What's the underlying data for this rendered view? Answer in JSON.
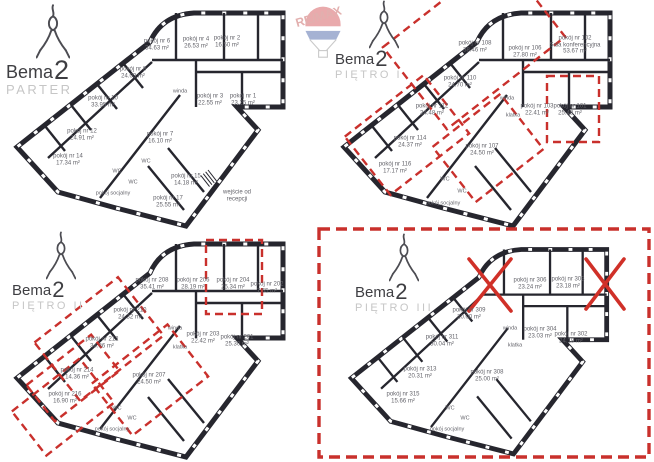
{
  "brand": {
    "name": "Bema",
    "number": "2",
    "watermark": "RE/MAX"
  },
  "colors": {
    "wall": "#26262e",
    "highlight_red": "#c9302c",
    "label_gray": "#63636a"
  },
  "floors": [
    {
      "name": "PARTER",
      "rooms": [
        {
          "label": "pokój nr 6",
          "area": "34.63 m²"
        },
        {
          "label": "pokój nr 4",
          "area": "26.53 m²"
        },
        {
          "label": "pokój nr 2",
          "area": "16.50 m²"
        },
        {
          "label": "pokój nr 8",
          "area": "24.03 m²"
        },
        {
          "label": "pokój nr 10",
          "area": "33.95 m²"
        },
        {
          "label": "pokój nr 3",
          "area": "22.55 m²"
        },
        {
          "label": "pokój nr 1",
          "area": "23.25 m²"
        },
        {
          "label": "pokój nr 12",
          "area": "24.91 m²"
        },
        {
          "label": "pokój nr 7",
          "area": "16.10 m²"
        },
        {
          "label": "pokój nr 14",
          "area": "17.34 m²"
        },
        {
          "label": "pokój nr 15",
          "area": "14.18 m²"
        },
        {
          "label": "pokój nr 17",
          "area": "25.55 m²"
        }
      ],
      "facilities": [
        {
          "label": "winda"
        },
        {
          "label": "WC"
        },
        {
          "label": "WC"
        },
        {
          "label": "WC"
        },
        {
          "label": "pokój socjalny"
        }
      ],
      "entrance_note": "wejście od recepcji"
    },
    {
      "name": "PIĘTRO I",
      "rooms": [
        {
          "label": "pokój nr 108",
          "area": "38.46 m²",
          "highlighted": true
        },
        {
          "label": "pokój nr 106",
          "area": "27.80 m²"
        },
        {
          "label": "pokój nr 102",
          "sublabel": "Sala konferencyjna",
          "area": "53.67 m²"
        },
        {
          "label": "pokój nr 110",
          "area": "24.70 m²",
          "highlighted": true
        },
        {
          "label": "pokój nr 112",
          "area": "34.48 m²",
          "highlighted": true
        },
        {
          "label": "pokój nr 103",
          "area": "22.41 m²"
        },
        {
          "label": "pokój nr 101",
          "area": "25.48 m²",
          "highlighted": true
        },
        {
          "label": "pokój nr 114",
          "area": "24.37 m²",
          "highlighted": true
        },
        {
          "label": "pokój nr 107",
          "area": "24.50 m²",
          "highlighted": true
        },
        {
          "label": "pokój nr 116",
          "area": "17.17 m²"
        }
      ],
      "facilities": [
        {
          "label": "winda"
        },
        {
          "label": "klatka"
        },
        {
          "label": "WC"
        },
        {
          "label": "WC"
        },
        {
          "label": "pokój socjalny"
        }
      ]
    },
    {
      "name": "PIĘTRO II",
      "rooms": [
        {
          "label": "pokój nr 208",
          "area": "35.41 m²"
        },
        {
          "label": "pokój nr 206",
          "area": "28.19 m²"
        },
        {
          "label": "pokój nr 204",
          "area": "25.34 m²",
          "highlighted": true
        },
        {
          "label": "pokój nr 202",
          "area": "7.55 m²"
        },
        {
          "label": "pokój nr 210",
          "area": "24.32 m²"
        },
        {
          "label": "pokój nr 212",
          "area": "34.36 m²",
          "highlighted": true
        },
        {
          "label": "pokój nr 203",
          "area": "22.42 m²"
        },
        {
          "label": "pokój nr 201",
          "area": "25.30 m²"
        },
        {
          "label": "pokój nr 214",
          "area": "14.36 m²",
          "highlighted": true
        },
        {
          "label": "pokój nr 207",
          "area": "24.50 m²",
          "highlighted": true
        },
        {
          "label": "pokój nr 216",
          "area": "16.90 m²",
          "highlighted": true
        }
      ],
      "facilities": [
        {
          "label": "winda"
        },
        {
          "label": "klatka"
        },
        {
          "label": "WC"
        },
        {
          "label": "WC"
        },
        {
          "label": "pokój socjalny"
        }
      ]
    },
    {
      "name": "PIĘTRO III",
      "whole_floor_highlighted": true,
      "crossed_out_rooms": 2,
      "rooms": [
        {
          "label": "pokój nr 306",
          "area": "23.24 m²"
        },
        {
          "label": "pokój nr 303",
          "area": "23.18 m²"
        },
        {
          "label": "pokój nr 309",
          "area": "20.00 m²"
        },
        {
          "label": "pokój nr 311",
          "area": "30.04 m²"
        },
        {
          "label": "pokój nr 304",
          "area": "23.03 m²"
        },
        {
          "label": "pokój nr 302",
          "area": "24.18 m²"
        },
        {
          "label": "pokój nr 313",
          "area": "20.31 m²"
        },
        {
          "label": "pokój nr 308",
          "area": "25.00 m²"
        },
        {
          "label": "pokój nr 315",
          "area": "15.66 m²"
        }
      ],
      "facilities": [
        {
          "label": "winda"
        },
        {
          "label": "klatka"
        },
        {
          "label": "WC"
        },
        {
          "label": "WC"
        },
        {
          "label": "pokój socjalny"
        }
      ]
    }
  ]
}
